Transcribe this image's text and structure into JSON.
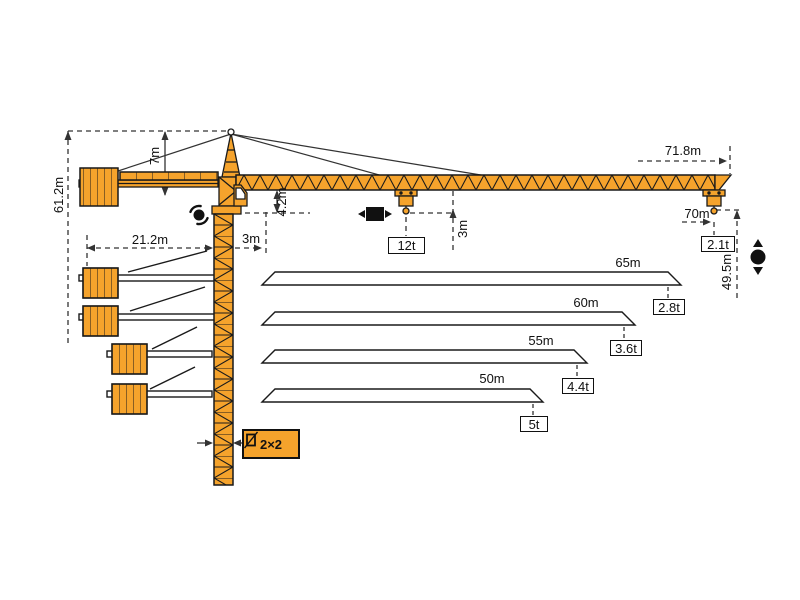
{
  "diagram_title": "tower-crane-working-range-diagram",
  "colors": {
    "crane_orange": "#F5A32C",
    "outline": "#1A1A1A",
    "dim_line": "#333333",
    "background": "#FFFFFF"
  },
  "dimensions": {
    "total_height": "61.2m",
    "tower_head_height": "7m",
    "counter_jib_radius": "21.2m",
    "min_radius": "3m",
    "jib_section_height": "4.2m",
    "hook_clearance": "3m",
    "max_capacity": "12t",
    "jib_length_overall": "71.8m",
    "max_radius": "70m",
    "tip_capacity": "2.1t",
    "hook_height": "49.5m",
    "mast_section": "2×2"
  },
  "jib_variants": [
    {
      "length": "65m",
      "tip_load": "2.8t"
    },
    {
      "length": "60m",
      "tip_load": "3.6t"
    },
    {
      "length": "55m",
      "tip_load": "4.4t"
    },
    {
      "length": "50m",
      "tip_load": "5t"
    }
  ],
  "icons": {
    "slewing": "slewing-icon",
    "trolley_travel": "trolley-travel-icon",
    "hoisting": "hoisting-icon",
    "mast_section": "mast-section-icon"
  }
}
